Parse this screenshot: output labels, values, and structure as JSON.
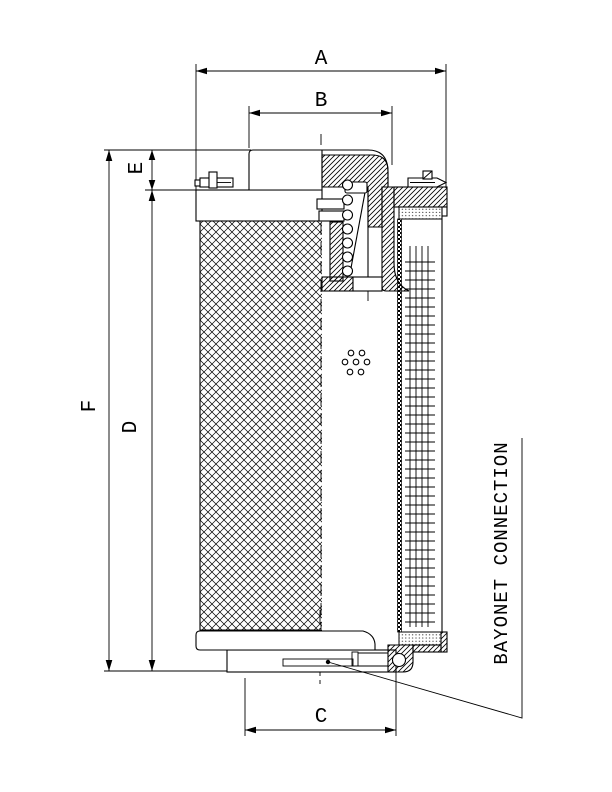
{
  "figure": {
    "type_hint": "filter element cross-section drawing",
    "callout": "BAYONET CONNECTION",
    "dim_labels": {
      "a": "A",
      "b": "B",
      "c": "C",
      "d": "D",
      "e": "E",
      "f": "F"
    },
    "colors": {
      "ink": "#000000",
      "paper": "#ffffff"
    }
  }
}
